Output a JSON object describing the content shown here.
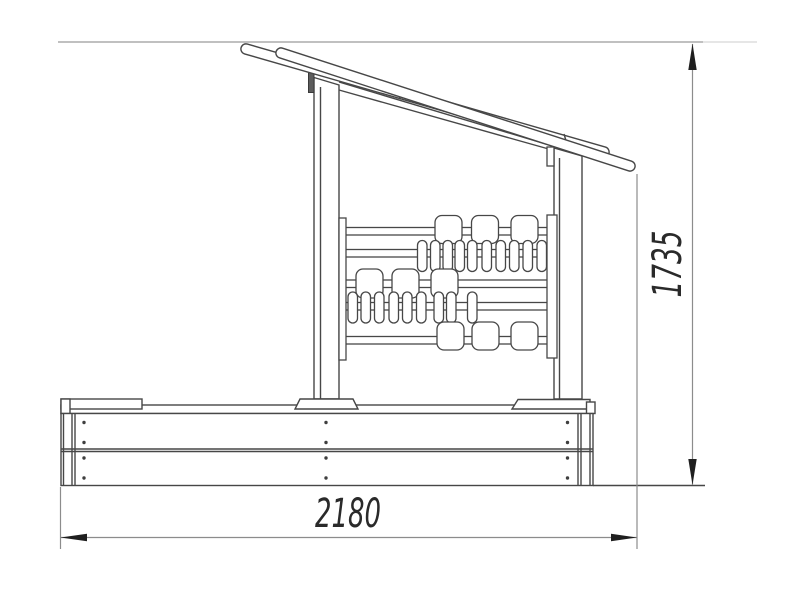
{
  "drawing": {
    "title": "sandbox-with-canopy-side-view",
    "canvas": {
      "width": 800,
      "height": 600,
      "background": "#ffffff"
    },
    "colors": {
      "outline": "#474747",
      "dimension_lines": "#8c8c8c",
      "arrows_text": "#1f1f1f"
    },
    "dimensions": {
      "width_label": "2180",
      "height_label": "1735"
    }
  }
}
